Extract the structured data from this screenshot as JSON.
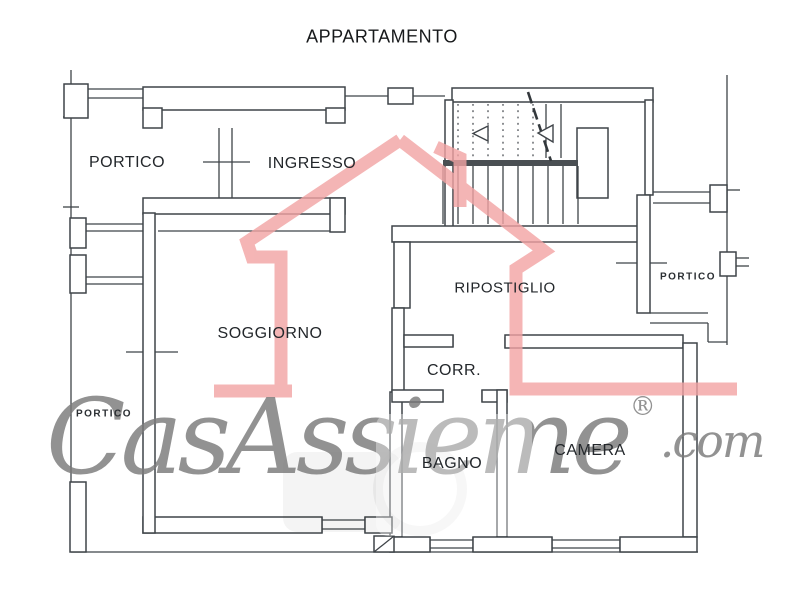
{
  "header": {
    "title": "APPARTAMENTO"
  },
  "rooms": {
    "portico_top_left": "PORTICO",
    "ingresso": "INGRESSO",
    "ripostiglio": "RIPOSTIGLIO",
    "soggiorno": "SOGGIORNO",
    "corridoio": "CORR.",
    "bagno": "BAGNO",
    "camera": "CAMERA",
    "portico_right": "PORTICO",
    "portico_left": "PORTICO"
  },
  "watermark": {
    "brand": "CasAssieme",
    "registered": "®",
    "suffix": ".com",
    "house_color": "#f2a3a3",
    "script_color": "#7a7a7a"
  },
  "drawing": {
    "line_color": "#3f4449",
    "background": "#ffffff"
  }
}
